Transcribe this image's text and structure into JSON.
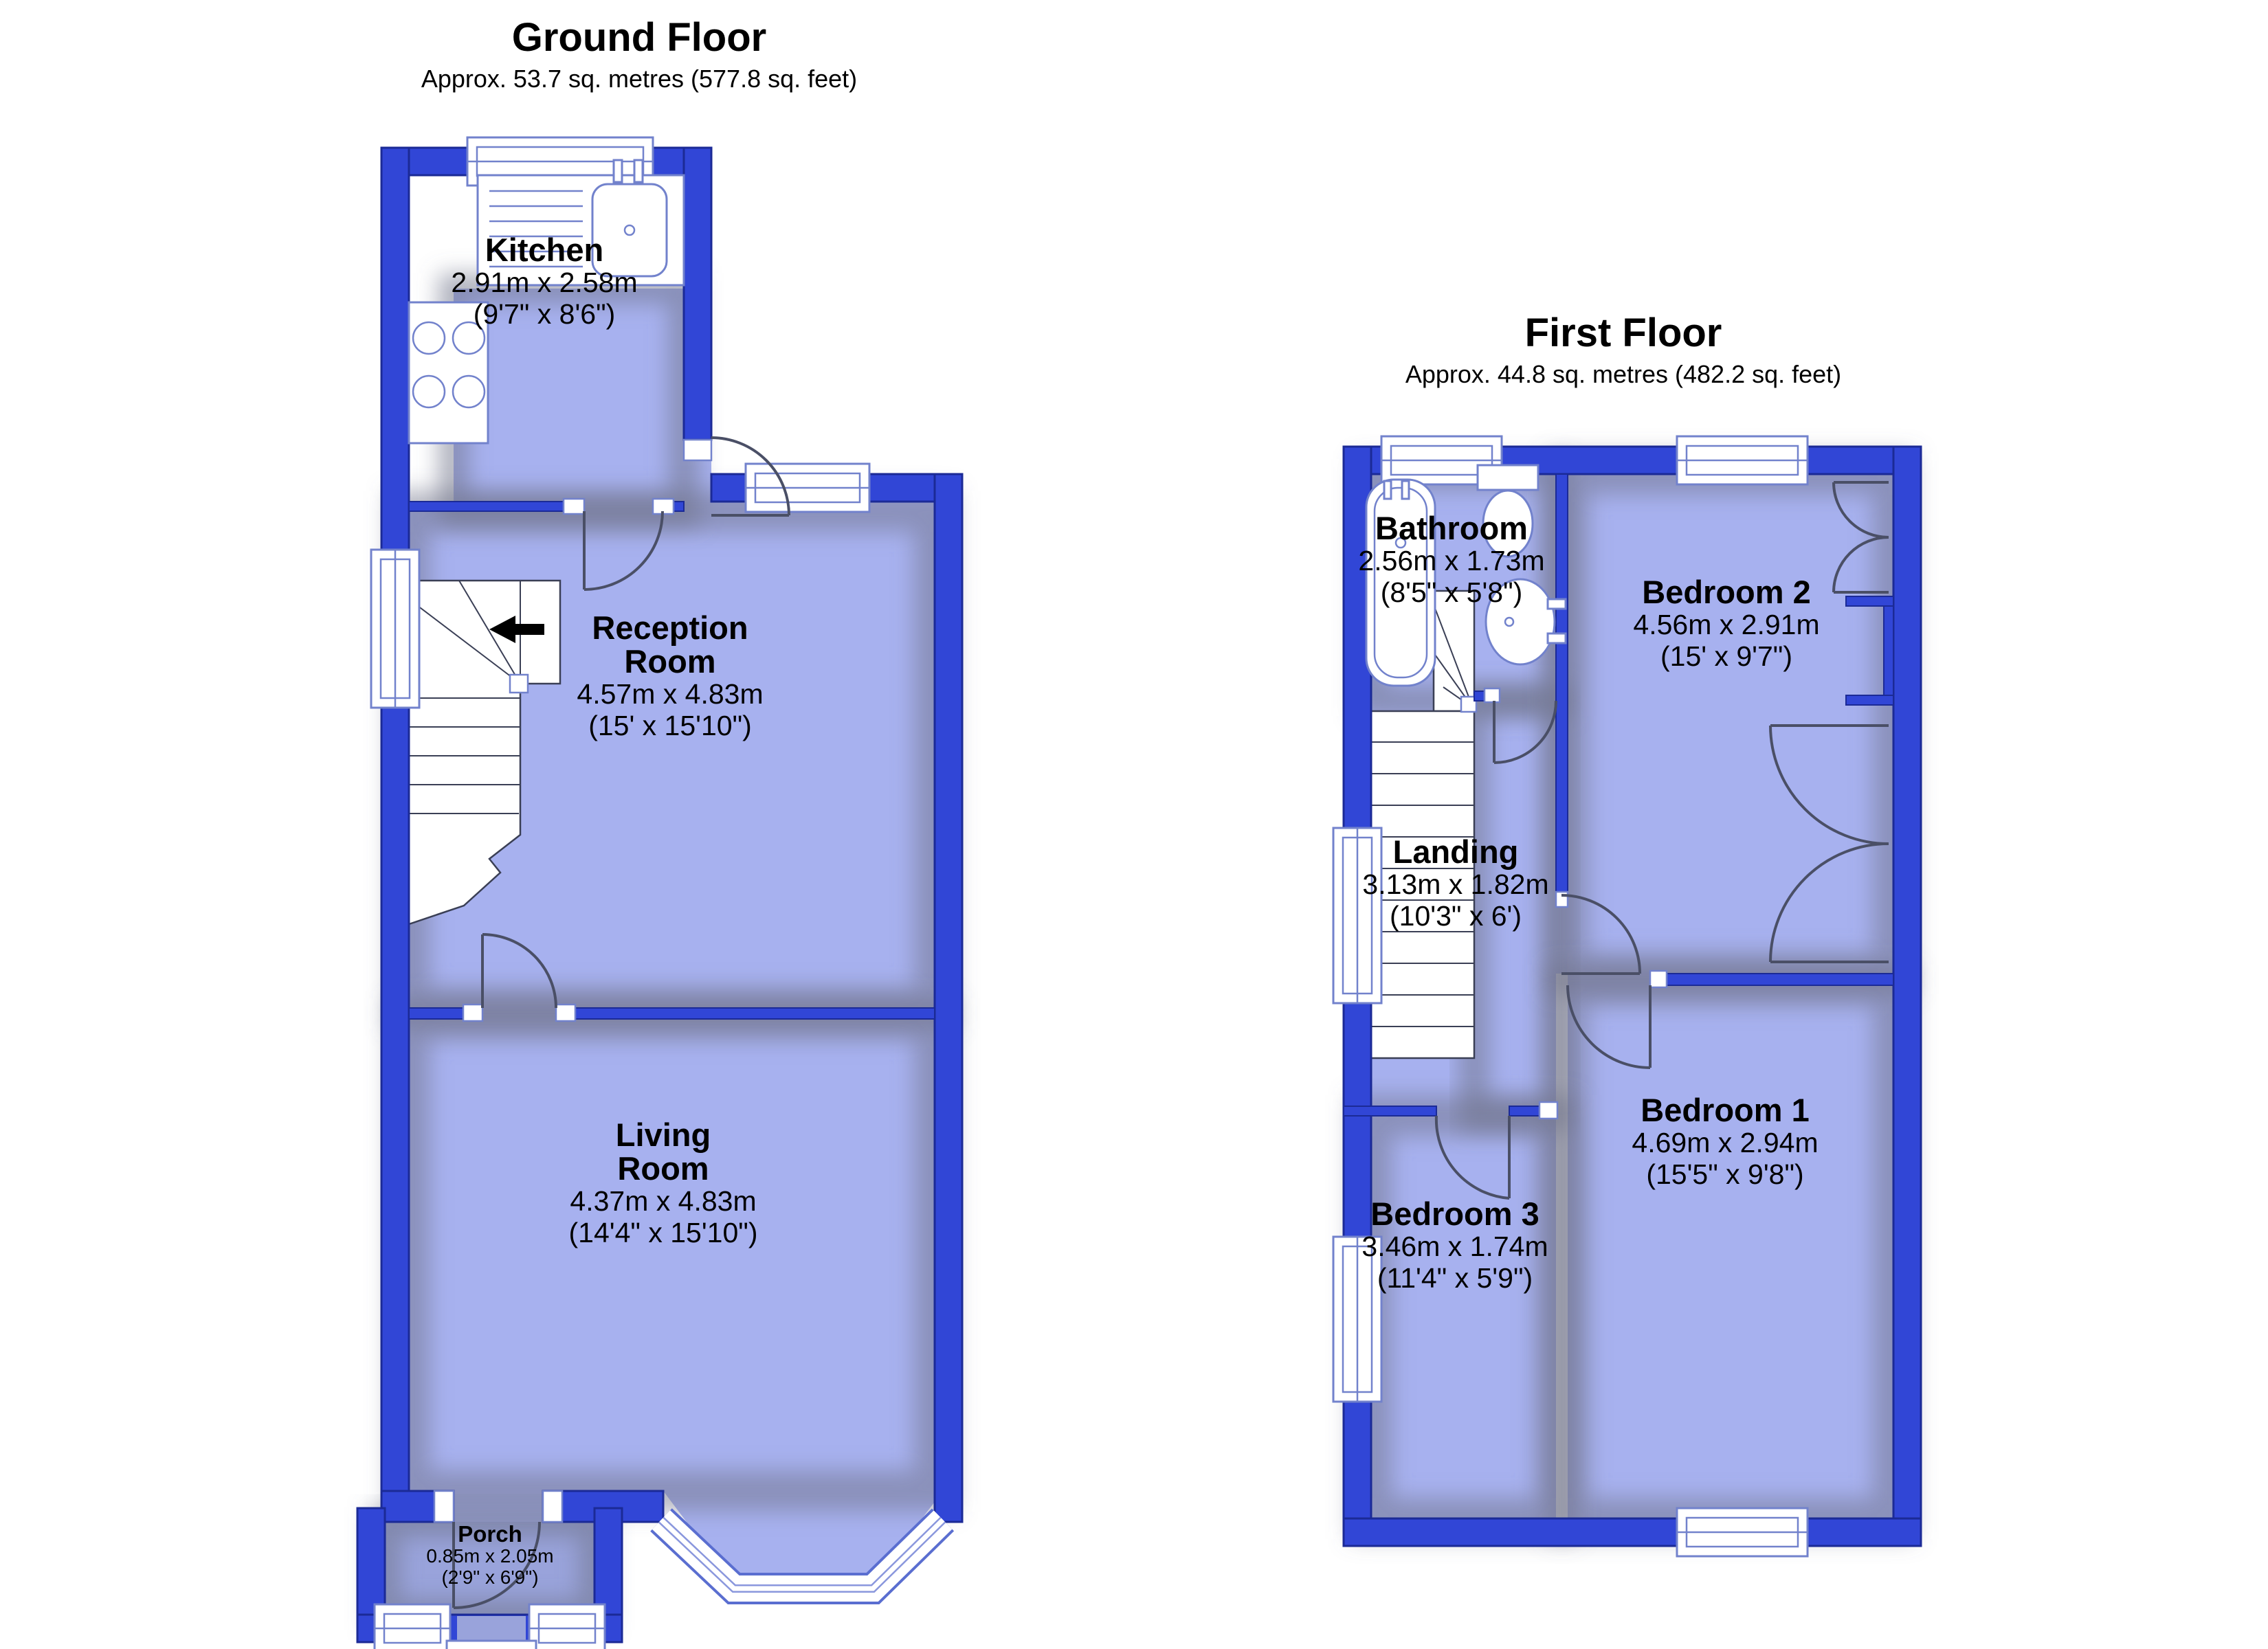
{
  "floors": [
    {
      "id": "ground",
      "title": "Ground Floor",
      "subtitle": "Approx. 53.7 sq. metres (577.8 sq. feet)",
      "rooms": [
        {
          "id": "kitchen",
          "name": "Kitchen",
          "dims_metric": "2.91m x 2.58m",
          "dims_imperial": "(9'7\" x 8'6\")"
        },
        {
          "id": "reception",
          "name": "Reception Room",
          "dims_metric": "4.57m x 4.83m",
          "dims_imperial": "(15' x 15'10\")"
        },
        {
          "id": "living",
          "name": "Living Room",
          "dims_metric": "4.37m x 4.83m",
          "dims_imperial": "(14'4\" x 15'10\")"
        },
        {
          "id": "porch",
          "name": "Porch",
          "dims_metric": "0.85m x 2.05m",
          "dims_imperial": "(2'9\" x 6'9\")"
        }
      ]
    },
    {
      "id": "first",
      "title": "First Floor",
      "subtitle": "Approx. 44.8 sq. metres (482.2 sq. feet)",
      "rooms": [
        {
          "id": "bathroom",
          "name": "Bathroom",
          "dims_metric": "2.56m x 1.73m",
          "dims_imperial": "(8'5\" x 5'8\")"
        },
        {
          "id": "bedroom2",
          "name": "Bedroom 2",
          "dims_metric": "4.56m x 2.91m",
          "dims_imperial": "(15' x 9'7\")"
        },
        {
          "id": "landing",
          "name": "Landing",
          "dims_metric": "3.13m x 1.82m",
          "dims_imperial": "(10'3\" x 6')"
        },
        {
          "id": "bedroom1",
          "name": "Bedroom 1",
          "dims_metric": "4.69m x 2.94m",
          "dims_imperial": "(15'5\" x 9'8\")"
        },
        {
          "id": "bedroom3",
          "name": "Bedroom 3",
          "dims_metric": "3.46m x 1.74m",
          "dims_imperial": "(11'4\" x 5'9\")"
        }
      ]
    }
  ],
  "colors": {
    "wall": "#3146d6",
    "wall_edge": "#1b2a96",
    "room_fill": "#a7b1ef",
    "porch_fill": "#99a3db",
    "fixture_stroke": "#7282cc",
    "door_arc": "#4a4f66",
    "arrow": "#000000"
  }
}
